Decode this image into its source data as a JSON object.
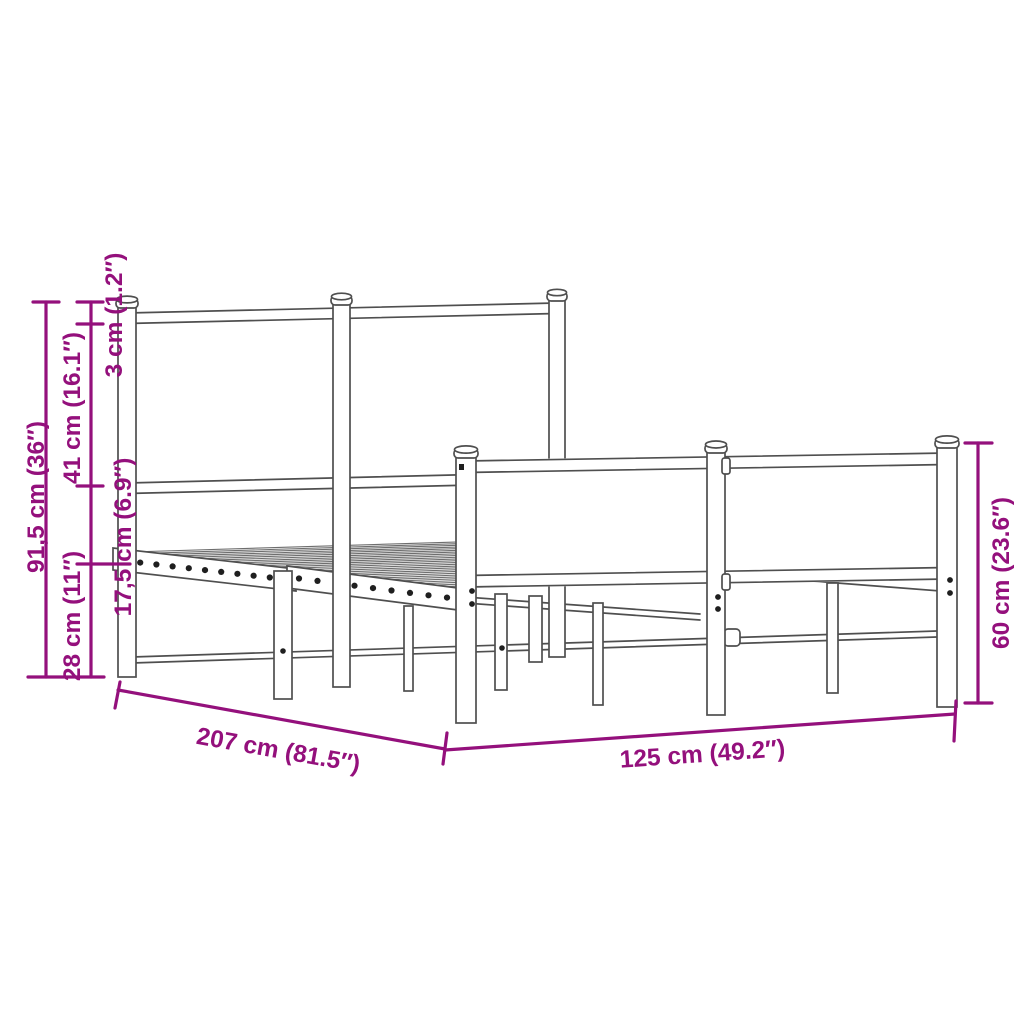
{
  "page": {
    "background": "#ffffff"
  },
  "drawing": {
    "subject": "metal bed frame with headboard and footboard, perspective line drawing",
    "line_color": "#4f4f4f",
    "accent_color": "#94107C"
  },
  "dimensions": {
    "overall_height": "91,5 cm (36″)",
    "headboard_upper_section": "41 cm (16.1″)",
    "ground_clearance": "28 cm (11″)",
    "top_rail_thickness": "3 cm (1.2″)",
    "side_rail_height": "17,5 cm (6.9″)",
    "footboard_height": "60 cm (23.6″)",
    "bed_length": "207 cm (81.5″)",
    "bed_width": "125 cm (49.2″)"
  }
}
